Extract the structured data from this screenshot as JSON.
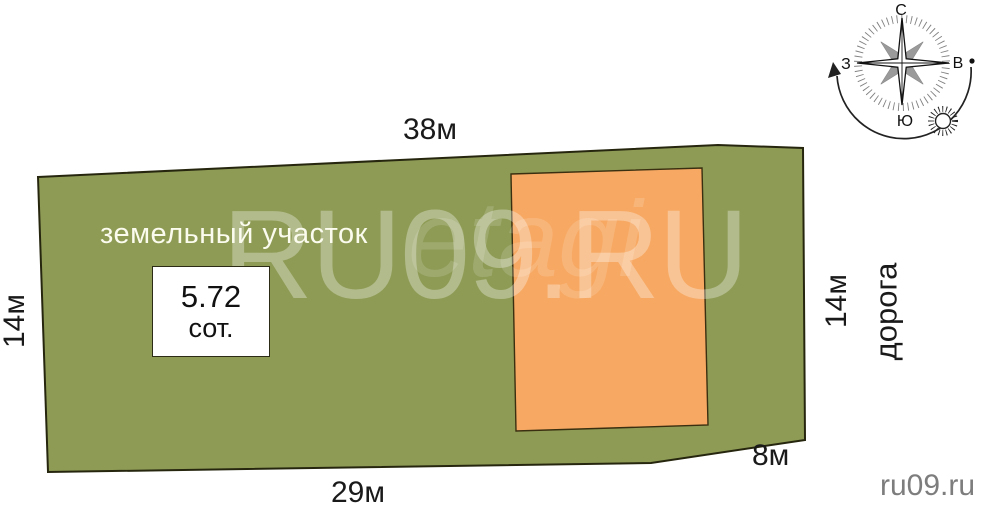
{
  "diagram": {
    "land_label": "земельный участок",
    "area": {
      "value": "5.72",
      "unit": "сот."
    },
    "dims": {
      "top": "38м",
      "bottom": "29м",
      "left": "14м",
      "right": "14м",
      "notch": "8м"
    },
    "road": "дорога"
  },
  "compass": {
    "north": "С",
    "east": "В",
    "south": "Ю",
    "west": "З"
  },
  "watermarks": {
    "big": "RU09.RU",
    "script": "etagi",
    "corner": "ru09.ru"
  },
  "colors": {
    "land": "#8e9b55",
    "building": "#f7a963",
    "outline": "#26260f",
    "star_gray": "#9a9a9a"
  }
}
